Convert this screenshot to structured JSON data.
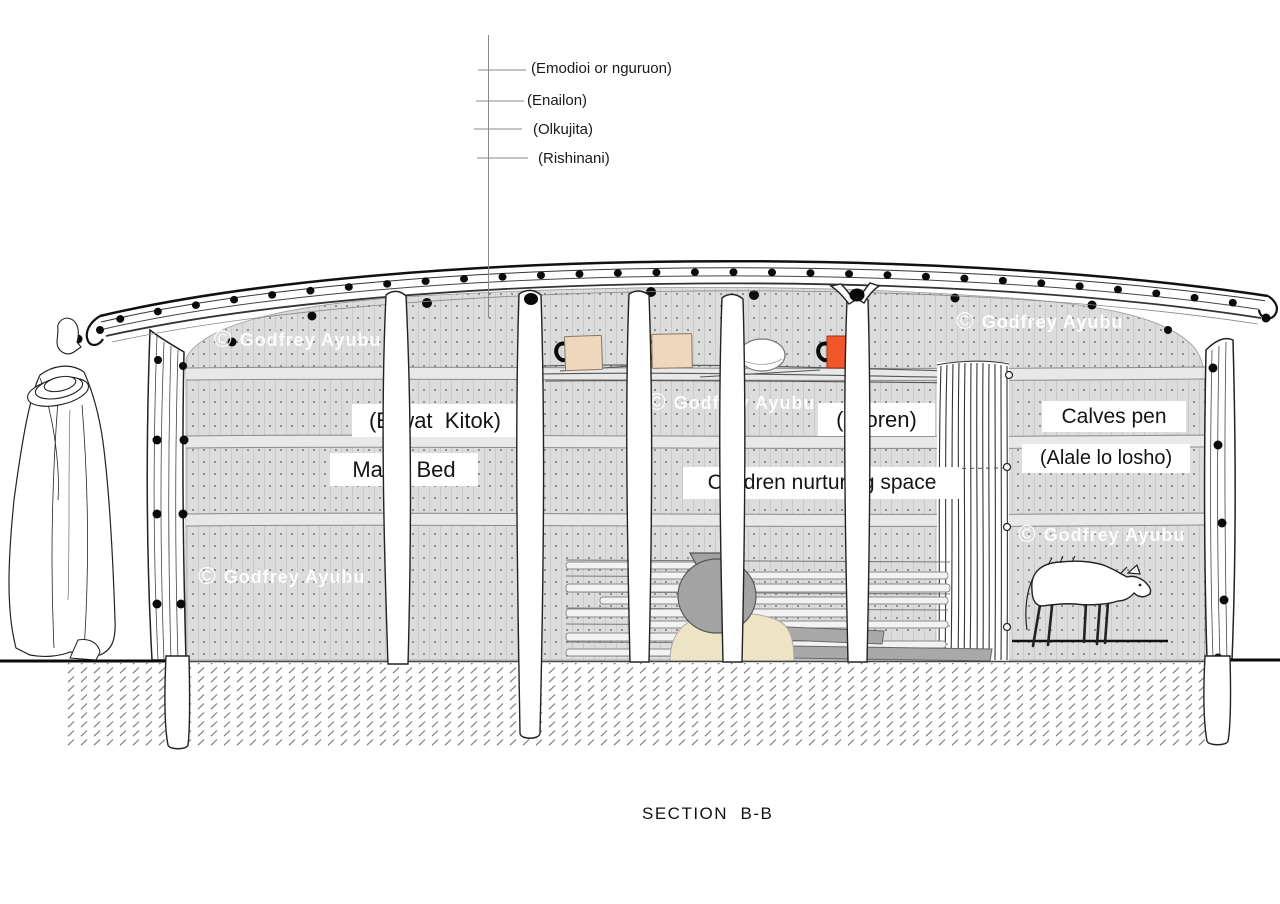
{
  "title": {
    "text": "SECTION  B-B"
  },
  "roof_layer_labels": [
    {
      "label": "(Emodioi or nguruon)"
    },
    {
      "label": "(Enailon)"
    },
    {
      "label": "(Olkujita)"
    },
    {
      "label": "(Rishinani)"
    }
  ],
  "space_labels": {
    "big_bed_maa": "(Erwat  Kitok)",
    "big_bed_en": "Man's Bed",
    "children_space_maa": "(Oloren)",
    "children_space_en": "Children nurturing space",
    "calves_pen_en": "Calves pen",
    "calves_pen_maa": "(Alale lo losho)"
  },
  "watermark": {
    "symbol": "©",
    "name": "Godfrey Ayubu"
  },
  "colors": {
    "wall_fill": "#dcdcdc",
    "wall_dot": "#8f8f8f",
    "orange_box": "#f0572b",
    "tan_box": "#eed7bd",
    "pot_grey": "#a3a3a3",
    "hearth_beige": "#ece4c4",
    "plank_grey": "#a9a9a9"
  }
}
